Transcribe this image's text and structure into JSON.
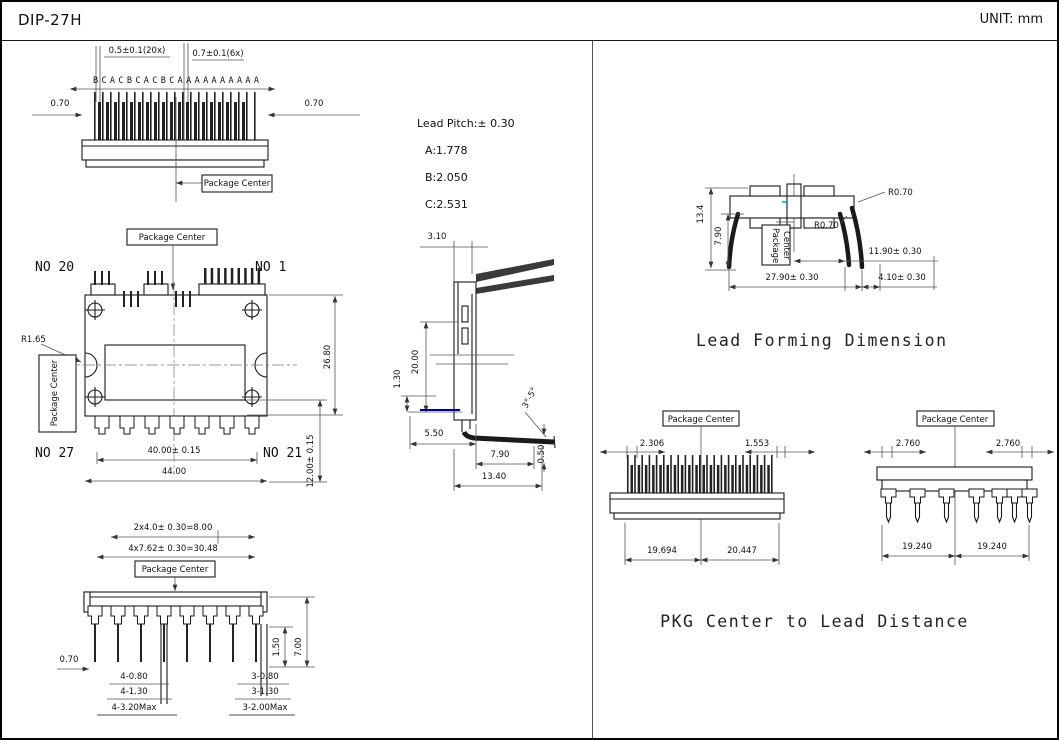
{
  "header": {
    "title": "DIP-27H",
    "unit": "UNIT: mm"
  },
  "colors": {
    "line": "#1a1a1a",
    "dim_line": "#555555",
    "accent_blue": "#00008b",
    "accent_cyan": "#00aaaa",
    "background": "#ffffff"
  },
  "top_view": {
    "pin_letters": "B C A C B C A C B C A A A A A A A A A A",
    "dim_pitch_20x": "0.5±0.1(20x)",
    "dim_pitch_6x": "0.7±0.1(6x)",
    "dim_left": "0.70",
    "dim_right": "0.70",
    "package_center": "Package Center"
  },
  "lead_pitch": {
    "title": "Lead Pitch:± 0.30",
    "items": [
      "A:1.778",
      "B:2.050",
      "C:2.531"
    ]
  },
  "front_view": {
    "package_center_top": "Package Center",
    "package_center_side": "Package Center",
    "no20": "NO 20",
    "no1": "NO 1",
    "no27": "NO 27",
    "no21": "NO 21",
    "radius": "R1.65",
    "dim_inner_width": "40.00± 0.15",
    "dim_outer_width": "44.00",
    "dim_height": "26.80",
    "dim_lower_height": "12.00± 0.15"
  },
  "side_view": {
    "dim_top_width": "3.10",
    "dim_body_height": "20.00",
    "dim_standoff": "1.30",
    "dim_base": "5.50",
    "dim_lead": "7.90",
    "dim_total": "13.40",
    "dim_tip": "0.50",
    "angle": "3°-5°"
  },
  "lead_forming": {
    "title": "Lead Forming Dimension",
    "dim_height": "13.4",
    "dim_leg_height": "7.90",
    "radius_top": "R0.70",
    "radius_mid": "R0.70",
    "dim_center_to_leg": "11.90± 0.30",
    "dim_body_width": "27.90± 0.30",
    "dim_leg_offset": "4.10± 0.30",
    "package_center_lines": [
      "Package",
      "Center"
    ]
  },
  "bottom_view": {
    "dim_pair_pitch": "2x4.0± 0.30=8.00",
    "dim_quad_pitch": "4x7.62± 0.30=30.48",
    "package_center": "Package Center",
    "dim_pin_width": "0.70",
    "dim_standoff": "1.50",
    "dim_pin_length": "7.00",
    "left_rows": [
      "4-0.80",
      "4-1.30",
      "4-3.20Max"
    ],
    "right_rows": [
      "3-0.80",
      "3-1.30",
      "3-2.00Max"
    ]
  },
  "pkg_distance": {
    "title": "PKG Center to Lead Distance",
    "left_view": {
      "package_center": "Package Center",
      "pitch_left": "2.306",
      "pitch_right": "1.553",
      "dist_left": "19.694",
      "dist_right": "20.447"
    },
    "right_view": {
      "package_center": "Package Center",
      "pitch_left": "2.760",
      "pitch_right": "2.760",
      "dist_left": "19.240",
      "dist_right": "19.240"
    }
  }
}
